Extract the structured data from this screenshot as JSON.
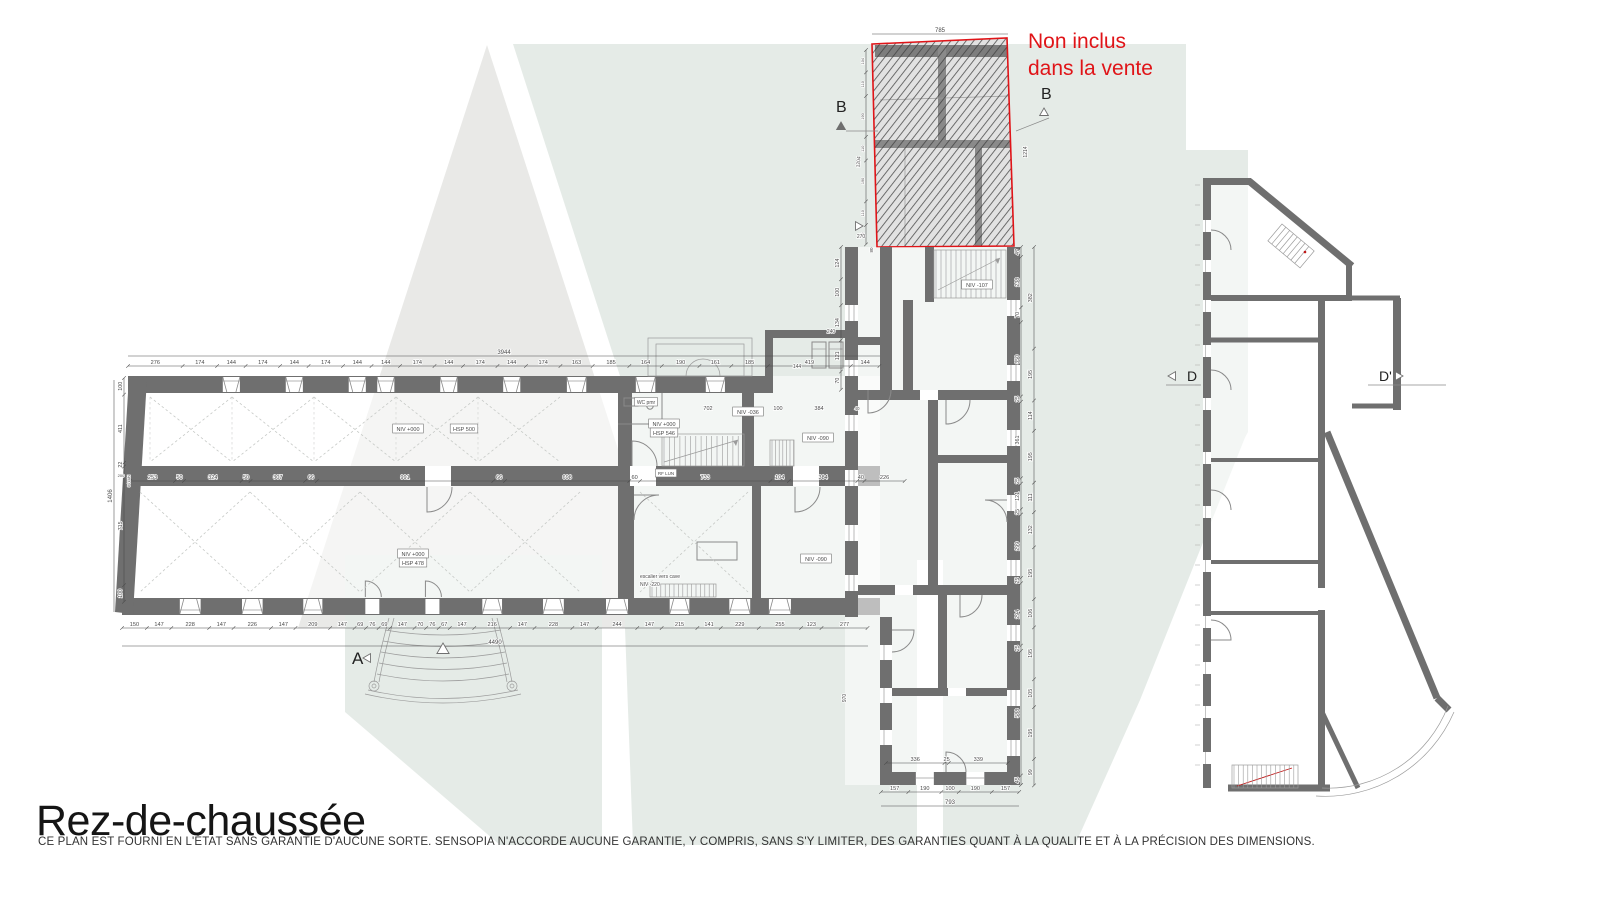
{
  "title": "Rez-de-chaussée",
  "disclaimer": "CE PLAN EST FOURNI EN L'ÉTAT SANS GARANTIE D'AUCUNE SORTE. SENSOPIA N'ACCORDE AUCUNE GARANTIE, Y COMPRIS, SANS S'Y LIMITER, DES GARANTIES QUANT À LA QUALITE ET À LA PRÉCISION DES DIMENSIONS.",
  "note": {
    "line1": "Non inclus",
    "line2": "dans la vente"
  },
  "plan": {
    "colors": {
      "wall": "#6f6f6f",
      "line": "#9b9b9b",
      "dim": "#4a4a4a",
      "red": "#e01418",
      "watermark_gray": "#e9e9e7",
      "watermark_green": "#e5ebe7",
      "title": "#151515",
      "disclaimer": "#333333"
    },
    "dim_chains": [
      {
        "name": "main-top",
        "x": 128,
        "y": 366,
        "dir": "h",
        "scale": 0.198,
        "windows": "top",
        "values": [
          276,
          174,
          144,
          174,
          144,
          174,
          144,
          144,
          174,
          144,
          174,
          144,
          174,
          163,
          185,
          164,
          190,
          161,
          185,
          419,
          144
        ]
      },
      {
        "name": "main-bottom",
        "x": 122,
        "y": 628,
        "dir": "h",
        "scale": 0.166,
        "windows": "bottom",
        "values": [
          150,
          147,
          228,
          147,
          226,
          147,
          209,
          147,
          69,
          76,
          69,
          147,
          70,
          76,
          67,
          147,
          216,
          147,
          228,
          147,
          244,
          147,
          215,
          141,
          229,
          255,
          123,
          277
        ]
      },
      {
        "name": "main-interior",
        "x": 130,
        "y": 481,
        "dir": "h",
        "scale": 0.178,
        "values": [
          253,
          50,
          324,
          50,
          307,
          66,
          991,
          66,
          698,
          60,
          733,
          104,
          384,
          40,
          226
        ]
      },
      {
        "name": "main-left",
        "x": 124,
        "y": 378,
        "dir": "v",
        "scale": 0.166,
        "values": [
          100,
          411,
          22,
          715,
          100
        ]
      },
      {
        "name": "annex-right-outer",
        "x": 1034,
        "y": 247,
        "dir": "v",
        "scale": 0.266,
        "values": [
          382,
          195,
          114,
          195,
          111,
          132,
          195,
          106,
          195,
          105,
          195,
          99
        ]
      },
      {
        "name": "annex-right-inner",
        "x": 1021,
        "y": 247,
        "dir": "v",
        "scale": 0.212,
        "values": [
          47,
          238,
          70,
          350,
          25,
          361,
          25,
          121,
          25,
          299,
          25,
          294,
          25,
          588,
          45
        ]
      },
      {
        "name": "annex-left-upper",
        "x": 841,
        "y": 247,
        "dir": "v",
        "scale": 0.26,
        "values": [
          124,
          100,
          134,
          121,
          70
        ]
      },
      {
        "name": "annex-bottom",
        "x": 881,
        "y": 792,
        "dir": "h",
        "scale": 0.174,
        "windows": "annex-bottom",
        "values": [
          157,
          190,
          100,
          190,
          157
        ]
      },
      {
        "name": "annex-bottom-inner",
        "x": 886,
        "y": 763,
        "dir": "h",
        "scale": 0.174,
        "values": [
          336,
          25,
          339
        ]
      },
      {
        "name": "excluded-left",
        "x": 866,
        "y": 50,
        "dir": "v",
        "scale": 0.215,
        "size": 3.8,
        "values": [
          104,
          110,
          190,
          110,
          190,
          110,
          90
        ]
      }
    ],
    "total_lines": [
      {
        "t": "3944",
        "dir": "h",
        "x1": 128,
        "x2": 880,
        "y": 356
      },
      {
        "t": "4490",
        "dir": "h",
        "x1": 122,
        "x2": 868,
        "y": 646
      },
      {
        "t": "785",
        "dir": "h",
        "x1": 872,
        "x2": 1008,
        "y": 34
      },
      {
        "t": "793",
        "dir": "h",
        "x1": 881,
        "x2": 1019,
        "y": 806
      },
      {
        "t": "1406",
        "dir": "v",
        "y1": 380,
        "y2": 612,
        "x": 114
      }
    ],
    "labels": [
      {
        "t": "200",
        "x": 121,
        "y": 477,
        "s": 4
      },
      {
        "t": "84 LUN",
        "x": 130,
        "y": 481,
        "s": 3.5,
        "r": -90
      },
      {
        "t": "1204",
        "x": 860,
        "y": 162,
        "r": -85,
        "s": 5
      },
      {
        "t": "1214",
        "x": 1027,
        "y": 152,
        "r": -90,
        "s": 5
      },
      {
        "t": "270",
        "x": 861,
        "y": 238,
        "s": 5
      },
      {
        "t": "80",
        "x": 873,
        "y": 250,
        "r": -90,
        "s": 4.5
      },
      {
        "t": "240",
        "x": 831,
        "y": 333,
        "s": 5
      },
      {
        "t": "144",
        "x": 797,
        "y": 368,
        "s": 5
      },
      {
        "t": "970",
        "x": 846,
        "y": 698,
        "r": -90,
        "s": 5
      },
      {
        "t": "702",
        "x": 708,
        "y": 410,
        "s": 5.5
      },
      {
        "t": "100",
        "x": 778,
        "y": 410,
        "s": 5.5
      },
      {
        "t": "384",
        "x": 819,
        "y": 410,
        "s": 5.5
      },
      {
        "t": "40",
        "x": 857,
        "y": 410,
        "s": 4.5
      },
      {
        "t": "WC pmr",
        "x": 646,
        "y": 404,
        "s": 5,
        "box": true
      },
      {
        "t": "NIV +000",
        "x": 408,
        "y": 431,
        "box": true
      },
      {
        "t": "HSP 500",
        "x": 464,
        "y": 431,
        "box": true
      },
      {
        "t": "NIV -036",
        "x": 748,
        "y": 414,
        "box": true
      },
      {
        "t": "NIV +000",
        "x": 664,
        "y": 426,
        "box": true
      },
      {
        "t": "HSP 546",
        "x": 664,
        "y": 435,
        "box": true
      },
      {
        "t": "NIV -090",
        "x": 818,
        "y": 440,
        "box": true
      },
      {
        "t": "RF LUN",
        "x": 666,
        "y": 475,
        "s": 4.5,
        "box": true
      },
      {
        "t": "NIV +000",
        "x": 413,
        "y": 556,
        "box": true
      },
      {
        "t": "HSP 478",
        "x": 413,
        "y": 565,
        "box": true
      },
      {
        "t": "NIV -090",
        "x": 816,
        "y": 561,
        "box": true
      },
      {
        "t": "escalier vers cave",
        "x": 640,
        "y": 578,
        "s": 5,
        "a": "start"
      },
      {
        "t": "NIV -220",
        "x": 640,
        "y": 586,
        "s": 5,
        "a": "start"
      },
      {
        "t": "NIV -107",
        "x": 977,
        "y": 287,
        "box": true
      }
    ],
    "markers": [
      {
        "t": "A",
        "x": 352,
        "y": 664,
        "fs": 17,
        "tri": {
          "x": 368,
          "y": 658,
          "dir": "left",
          "filled": false
        }
      },
      {
        "t": "B",
        "x": 836,
        "y": 112,
        "fs": 16,
        "tri": {
          "x": 841,
          "y": 127,
          "dir": "up",
          "filled": true
        },
        "line": [
          846,
          131,
          878,
          131
        ]
      },
      {
        "t": "B",
        "x": 1041,
        "y": 99,
        "fs": 16,
        "tri": {
          "x": 1044,
          "y": 113,
          "dir": "up",
          "filled": false
        },
        "line": [
          1016,
          131,
          1049,
          118
        ]
      },
      {
        "t": "D",
        "x": 1187,
        "y": 381,
        "fs": 14,
        "tri": {
          "x": 1173,
          "y": 376,
          "dir": "left",
          "filled": false
        },
        "line": [
          1166,
          385,
          1201,
          385
        ]
      },
      {
        "t": "D'",
        "x": 1379,
        "y": 381,
        "fs": 14,
        "tri": {
          "x": 1398,
          "y": 376,
          "dir": "right",
          "filled": false
        },
        "line": [
          1368,
          385,
          1446,
          385
        ]
      },
      {
        "t": "",
        "x": 0,
        "y": 0,
        "fs": 0,
        "tri": {
          "x": 858,
          "y": 226,
          "dir": "right",
          "filled": false
        }
      },
      {
        "t": "",
        "x": 0,
        "y": 0,
        "fs": 0,
        "tri": {
          "x": 443,
          "y": 650,
          "dir": "up",
          "filled": false,
          "s": 7
        }
      }
    ]
  }
}
